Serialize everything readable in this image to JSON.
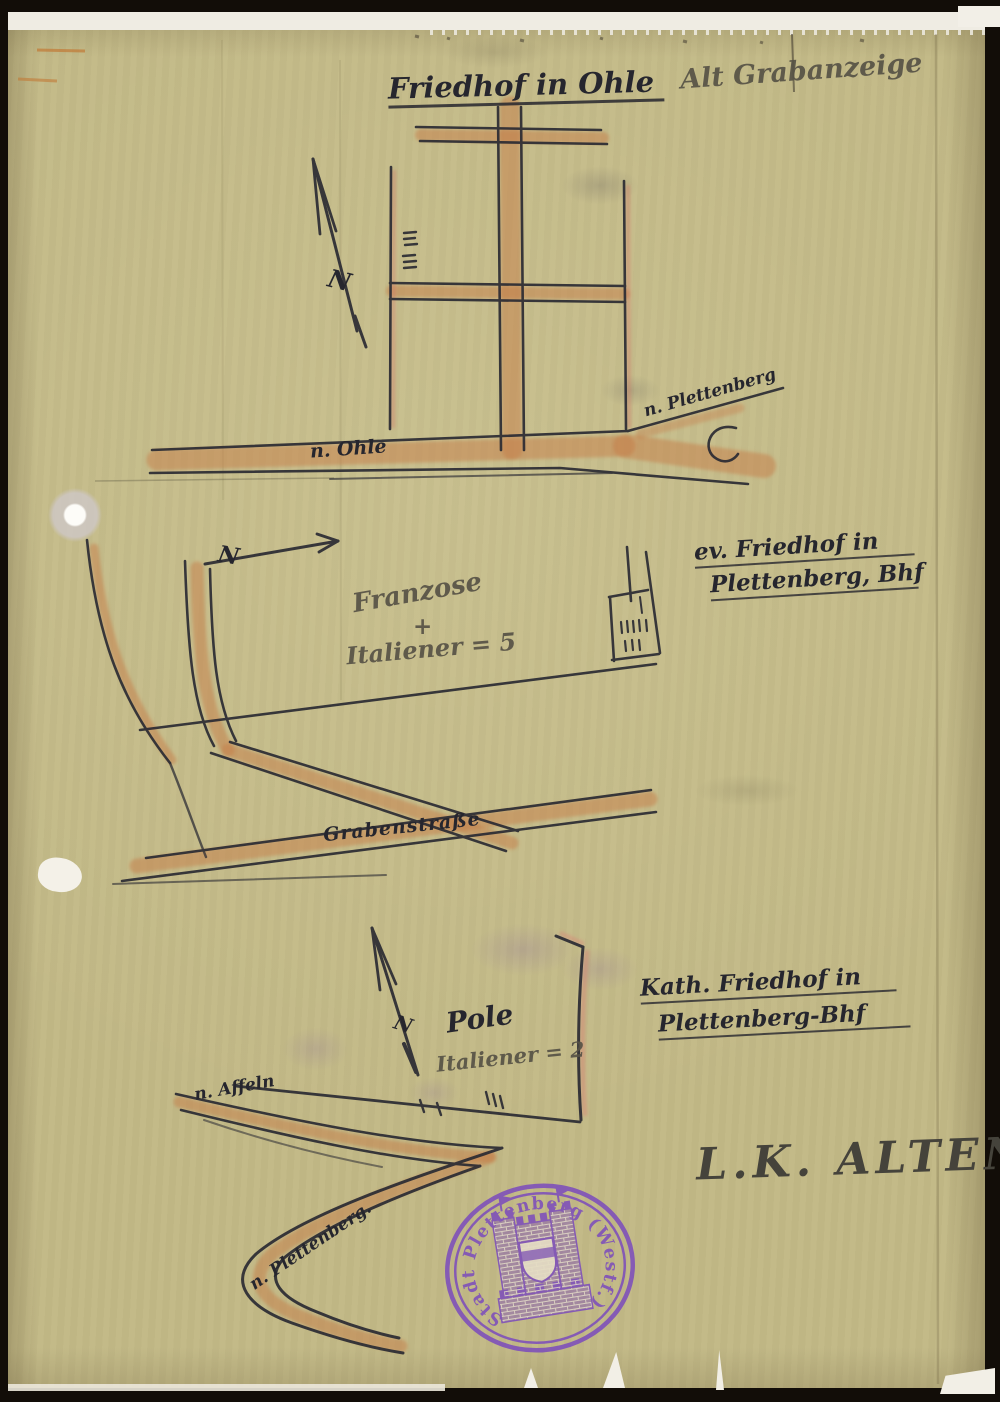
{
  "notes": {
    "grave_notice": "Alt Grabanzeige",
    "district": "L.K. ALTENA"
  },
  "maps": [
    {
      "title": "Friedhof in Ohle",
      "compass": "N",
      "road_left": "n. Ohle",
      "road_right": "n. Plettenberg"
    },
    {
      "title_line1": "ev. Friedhof in",
      "title_line2": "Plettenberg, Bhf",
      "compass": "N",
      "count_note_line1": "Franzose",
      "count_note_line2": "+",
      "count_note_line3": "Italiener = 5",
      "road": "Grabenstraße"
    },
    {
      "title_line1": "Kath. Friedhof in",
      "title_line2": "Plettenberg-Bhf",
      "compass": "N",
      "nationality_note": "Pole",
      "count_note": "Italiener = 2",
      "road_left": "n. Affeln",
      "road_bottom": "n. Plettenberg."
    }
  ],
  "stamp": {
    "ring_text": "Stadt Plettenberg (Westf.)"
  },
  "colors": {
    "paper": "#c3ba88",
    "ink": "#26262e",
    "pencil": "#585347",
    "road_orange": "#c07f50",
    "accent_pink": "#d66e64",
    "stamp_purple": "#7b4bbd",
    "background": "#120d08"
  }
}
